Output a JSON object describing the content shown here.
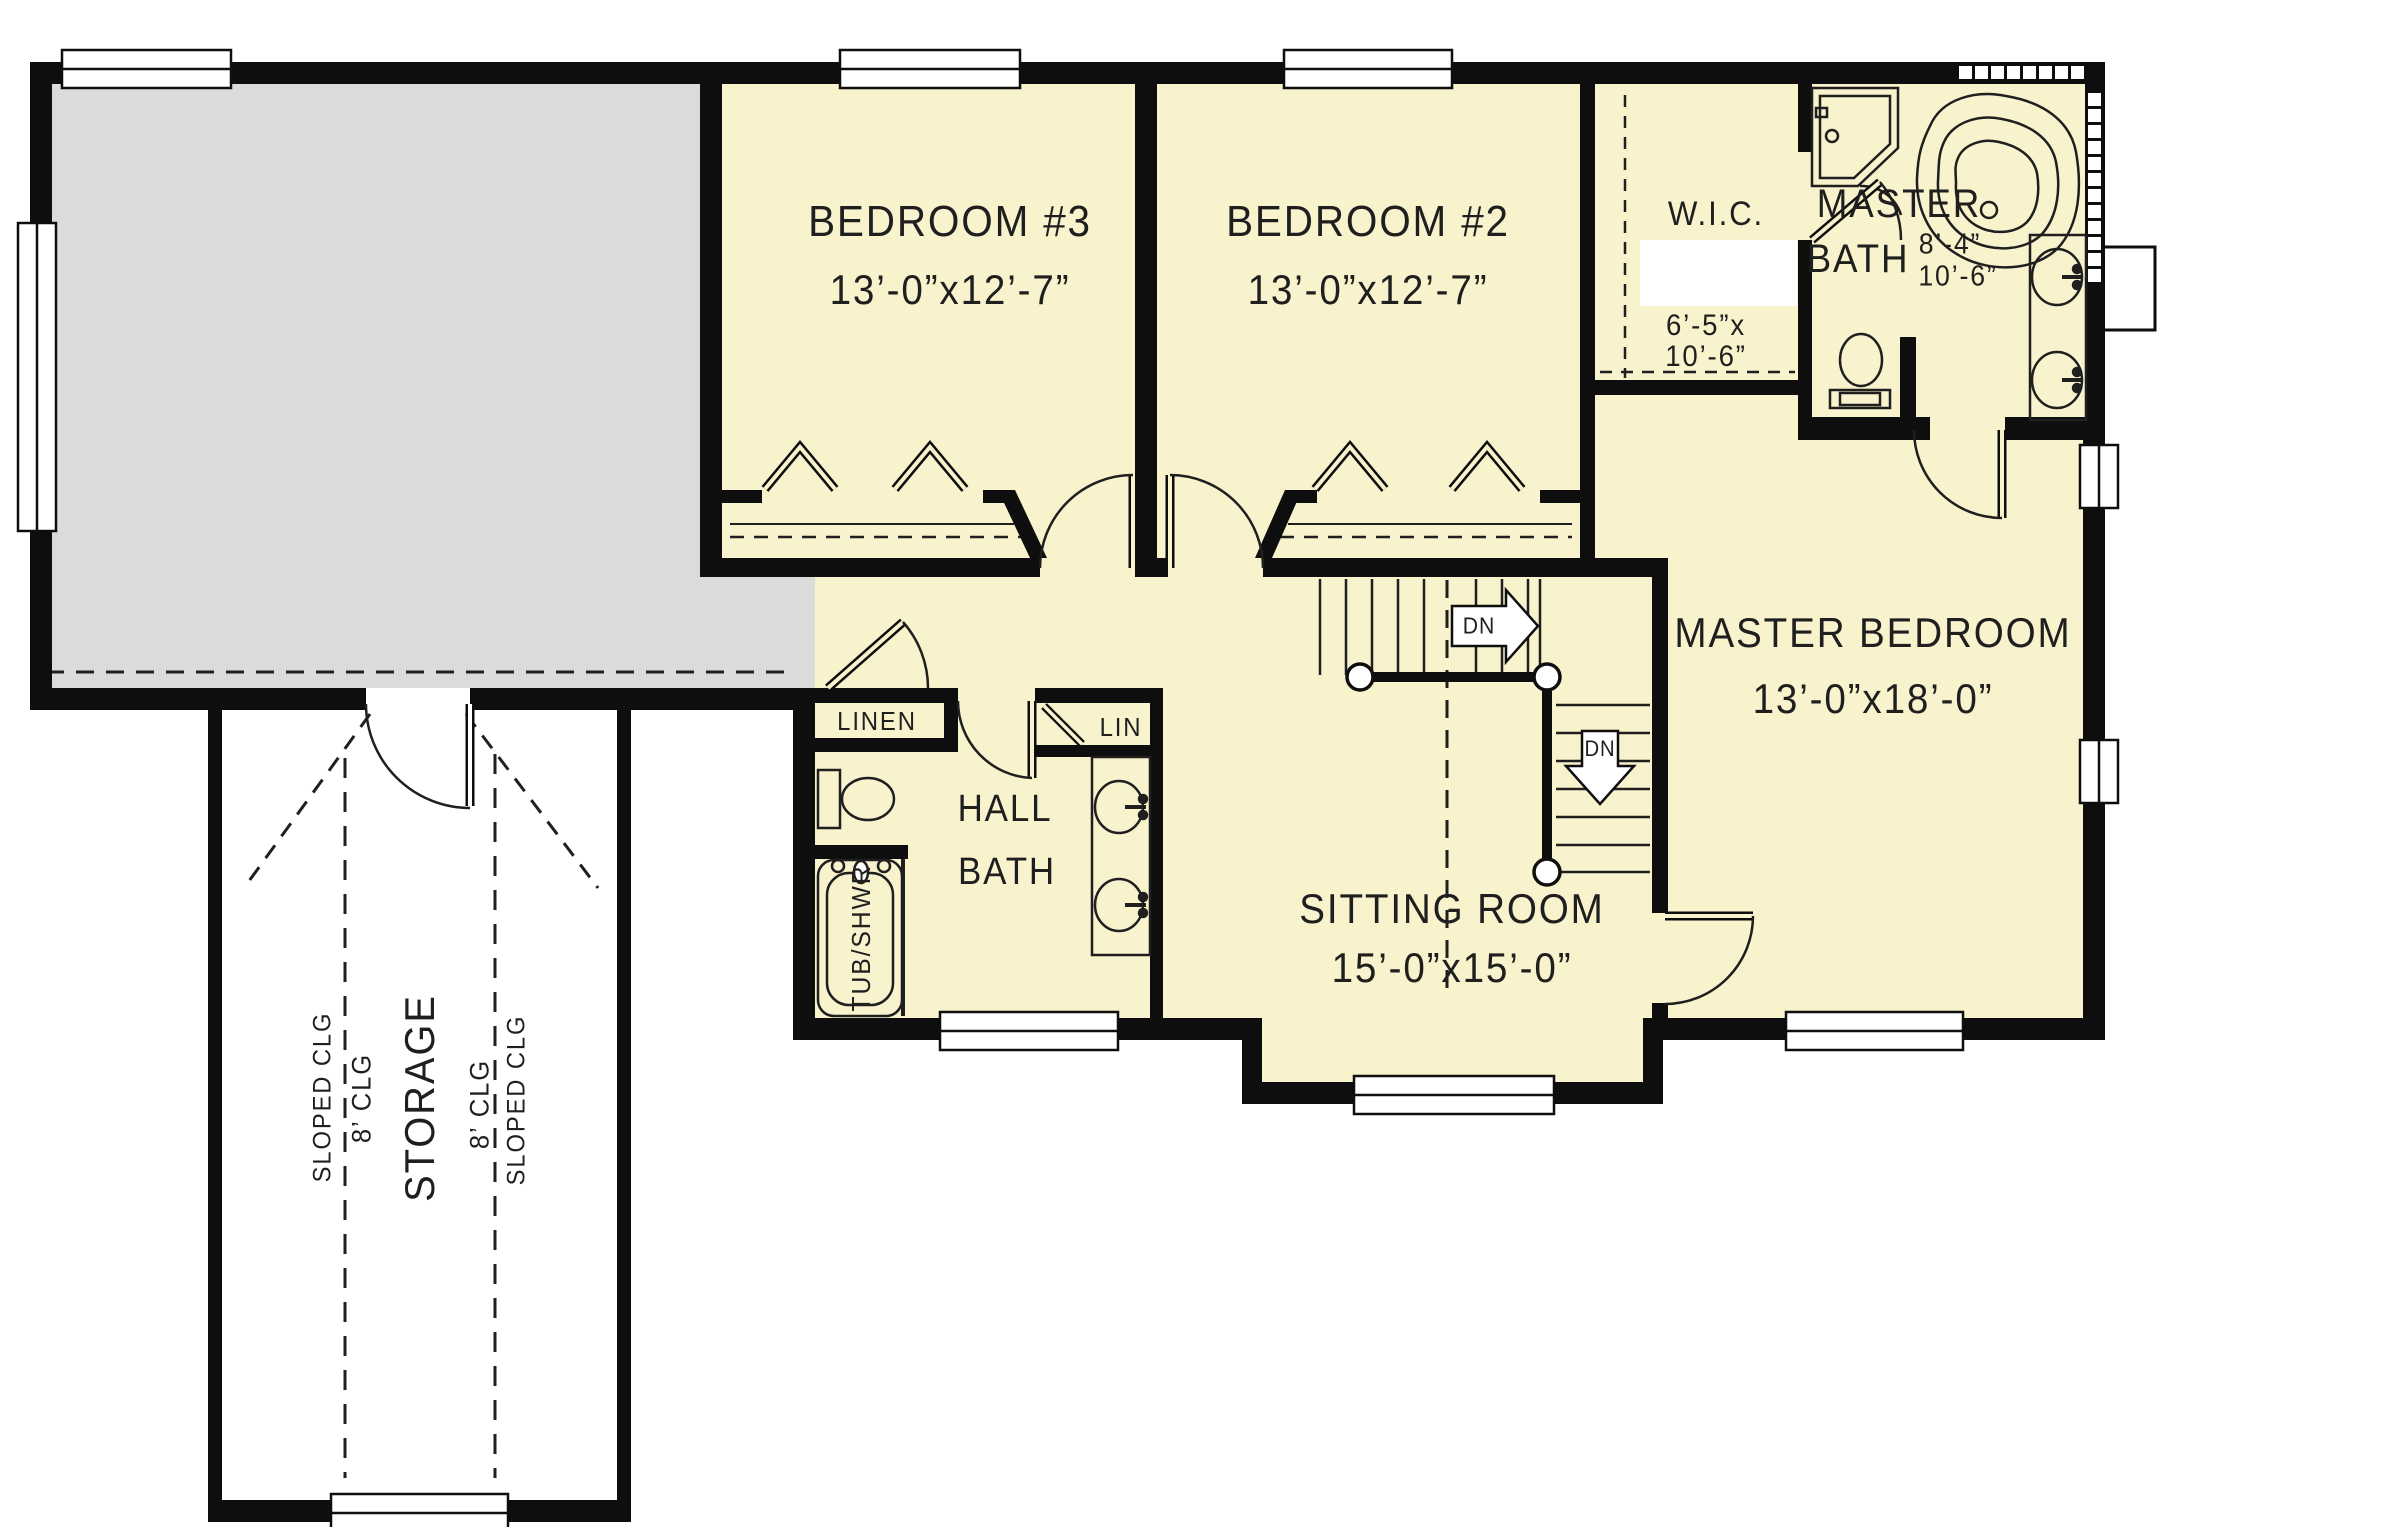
{
  "drawing": {
    "type": "floor-plan",
    "colors": {
      "room_fill": "#f8f2cd",
      "attic_fill": "#dbdbdb",
      "wall": "#0e0e0e",
      "line": "#1f1f1f"
    }
  },
  "rooms": {
    "bedroom3": {
      "name": "BEDROOM #3",
      "dims": "13’-0”x12’-7”"
    },
    "bedroom2": {
      "name": "BEDROOM #2",
      "dims": "13’-0”x12’-7”"
    },
    "wic": {
      "name": "W.I.C.",
      "dims1": "6’-5”x",
      "dims2": "10’-6”"
    },
    "master_bath": {
      "name1": "MASTER",
      "name2": "BATH",
      "dims1": "8’-4”",
      "dims2": "10’-6”"
    },
    "master_bedroom": {
      "name": "MASTER BEDROOM",
      "dims": "13’-0”x18’-0”"
    },
    "sitting_room": {
      "name": "SITTING ROOM",
      "dims": "15’-0”x15’-0”"
    },
    "hall_bath": {
      "name1": "HALL",
      "name2": "BATH"
    },
    "linen": {
      "name": "LINEN"
    },
    "lin": {
      "name": "LIN"
    },
    "tub": {
      "label": "TUB/SHWR"
    },
    "storage": {
      "name": "STORAGE",
      "sloped": "SLOPED CLG",
      "clg8": "8’ CLG"
    }
  },
  "stairs": {
    "dn": "DN"
  }
}
